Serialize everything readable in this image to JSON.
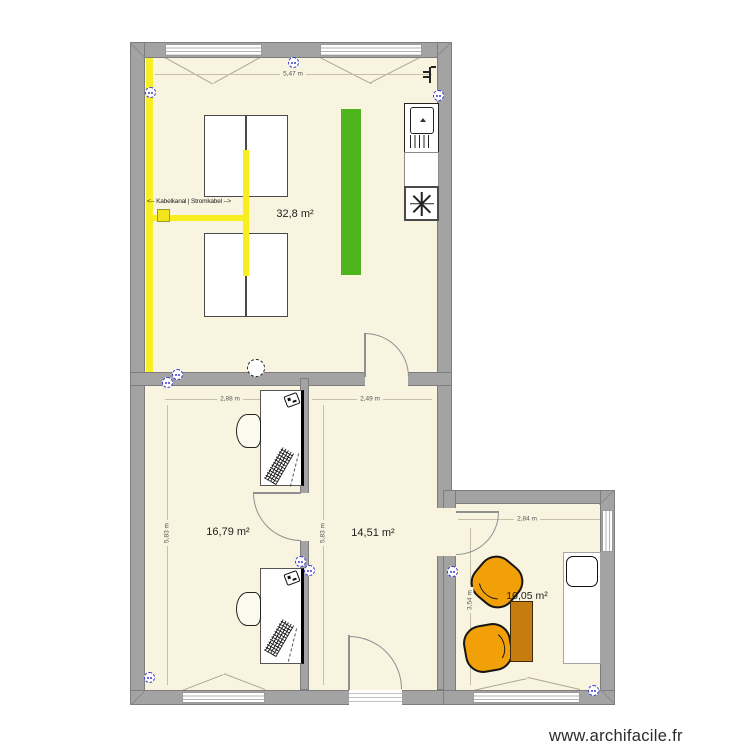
{
  "plan": {
    "watermark": "www.archifacile.fr",
    "cable_label": "<-- Kabelkanal | Stromkabel -->",
    "rooms": [
      {
        "area_label": "32,8 m²",
        "width_label": "5,47 m"
      },
      {
        "area_label": "16,79 m²",
        "width_label": "2,88 m",
        "height_label": "5,83 m"
      },
      {
        "area_label": "14,51 m²",
        "width_label": "2,49 m",
        "height_label": "5,83 m"
      },
      {
        "area_label": "10,05 m²",
        "width_label": "2,84 m",
        "height_label": "3,54 m"
      }
    ],
    "colors": {
      "floor": "#f9f4e0",
      "wall": "#a3a3a3",
      "cable_yellow": "#f6ee27",
      "highlight_green": "#4db41e",
      "armchair_orange": "#f2a007",
      "side_table_brown": "#c57d12",
      "outlet_blue": "#3c3ccf"
    }
  }
}
